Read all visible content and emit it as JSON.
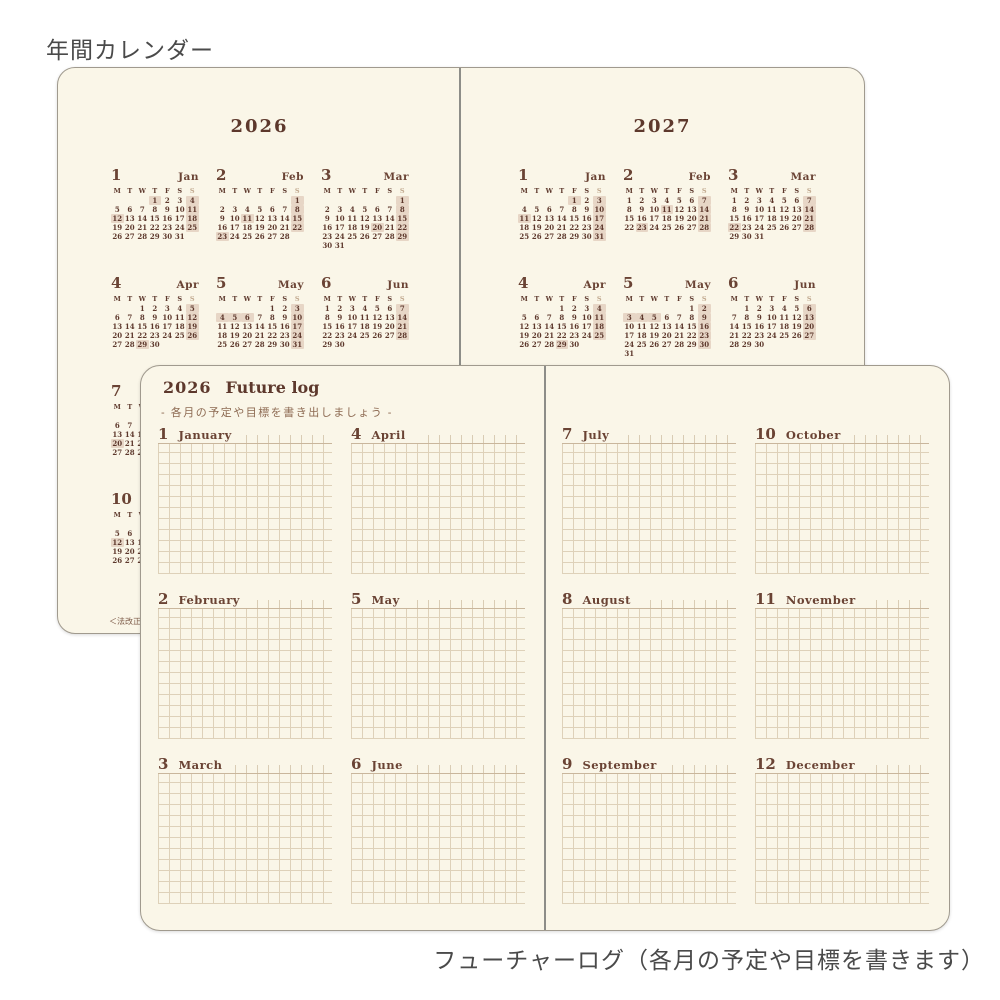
{
  "captions": {
    "top": "年間カレンダー",
    "bottom": "フューチャーログ（各月の予定や目標を書きます）"
  },
  "colors": {
    "paper": "#faf6e8",
    "ink": "#5d382c",
    "highlight": "#e7d6c6",
    "grid_line": "#ded1b9",
    "grid_line_dark": "#c9b69c",
    "sunday_header": "#c2aa90",
    "gutter": "#8d8d88",
    "caption": "#4a4a4a"
  },
  "yearly_calendar": {
    "weekday_header": [
      "M",
      "T",
      "W",
      "T",
      "F",
      "S",
      "S"
    ],
    "footnote": "＜法改正",
    "pages": [
      {
        "year": "2026",
        "months": [
          {
            "num": "1",
            "name": "Jan",
            "row": 0,
            "col": 0,
            "highlights": [
              "1",
              "4",
              "11",
              "12",
              "18",
              "25"
            ],
            "weeks": [
              [
                "",
                "",
                "",
                "1",
                "2",
                "3",
                "4"
              ],
              [
                "5",
                "6",
                "7",
                "8",
                "9",
                "10",
                "11"
              ],
              [
                "12",
                "13",
                "14",
                "15",
                "16",
                "17",
                "18"
              ],
              [
                "19",
                "20",
                "21",
                "22",
                "23",
                "24",
                "25"
              ],
              [
                "26",
                "27",
                "28",
                "29",
                "30",
                "31",
                ""
              ]
            ]
          },
          {
            "num": "2",
            "name": "Feb",
            "row": 0,
            "col": 1,
            "highlights": [
              "1",
              "8",
              "11",
              "15",
              "22",
              "23"
            ],
            "weeks": [
              [
                "",
                "",
                "",
                "",
                "",
                "",
                "1"
              ],
              [
                "2",
                "3",
                "4",
                "5",
                "6",
                "7",
                "8"
              ],
              [
                "9",
                "10",
                "11",
                "12",
                "13",
                "14",
                "15"
              ],
              [
                "16",
                "17",
                "18",
                "19",
                "20",
                "21",
                "22"
              ],
              [
                "23",
                "24",
                "25",
                "26",
                "27",
                "28",
                ""
              ]
            ]
          },
          {
            "num": "3",
            "name": "Mar",
            "row": 0,
            "col": 2,
            "highlights": [
              "1",
              "8",
              "15",
              "20",
              "22",
              "29"
            ],
            "weeks": [
              [
                "",
                "",
                "",
                "",
                "",
                "",
                "1"
              ],
              [
                "2",
                "3",
                "4",
                "5",
                "6",
                "7",
                "8"
              ],
              [
                "9",
                "10",
                "11",
                "12",
                "13",
                "14",
                "15"
              ],
              [
                "16",
                "17",
                "18",
                "19",
                "20",
                "21",
                "22"
              ],
              [
                "23",
                "24",
                "25",
                "26",
                "27",
                "28",
                "29"
              ],
              [
                "30",
                "31",
                "",
                "",
                "",
                "",
                ""
              ]
            ]
          },
          {
            "num": "4",
            "name": "Apr",
            "row": 1,
            "col": 0,
            "highlights": [
              "5",
              "12",
              "19",
              "26",
              "29"
            ],
            "weeks": [
              [
                "",
                "",
                "1",
                "2",
                "3",
                "4",
                "5"
              ],
              [
                "6",
                "7",
                "8",
                "9",
                "10",
                "11",
                "12"
              ],
              [
                "13",
                "14",
                "15",
                "16",
                "17",
                "18",
                "19"
              ],
              [
                "20",
                "21",
                "22",
                "23",
                "24",
                "25",
                "26"
              ],
              [
                "27",
                "28",
                "29",
                "30",
                "",
                "",
                ""
              ]
            ]
          },
          {
            "num": "5",
            "name": "May",
            "row": 1,
            "col": 1,
            "highlights": [
              "3",
              "4",
              "5",
              "6",
              "10",
              "17",
              "24",
              "31"
            ],
            "weeks": [
              [
                "",
                "",
                "",
                "",
                "1",
                "2",
                "3"
              ],
              [
                "4",
                "5",
                "6",
                "7",
                "8",
                "9",
                "10"
              ],
              [
                "11",
                "12",
                "13",
                "14",
                "15",
                "16",
                "17"
              ],
              [
                "18",
                "19",
                "20",
                "21",
                "22",
                "23",
                "24"
              ],
              [
                "25",
                "26",
                "27",
                "28",
                "29",
                "30",
                "31"
              ]
            ]
          },
          {
            "num": "6",
            "name": "Jun",
            "row": 1,
            "col": 2,
            "highlights": [
              "7",
              "14",
              "21",
              "28"
            ],
            "weeks": [
              [
                "1",
                "2",
                "3",
                "4",
                "5",
                "6",
                "7"
              ],
              [
                "8",
                "9",
                "10",
                "11",
                "12",
                "13",
                "14"
              ],
              [
                "15",
                "16",
                "17",
                "18",
                "19",
                "20",
                "21"
              ],
              [
                "22",
                "23",
                "24",
                "25",
                "26",
                "27",
                "28"
              ],
              [
                "29",
                "30",
                "",
                "",
                "",
                "",
                ""
              ]
            ]
          },
          {
            "num": "7",
            "name": "Jul",
            "row": 2,
            "col": 0,
            "highlights": [
              "5",
              "12",
              "19",
              "20",
              "26"
            ],
            "weeks": [
              [
                "",
                "",
                "1",
                "2",
                "3",
                "4",
                "5"
              ],
              [
                "6",
                "7",
                "8",
                "9",
                "10",
                "11",
                "12"
              ],
              [
                "13",
                "14",
                "15",
                "16",
                "17",
                "18",
                "19"
              ],
              [
                "20",
                "21",
                "22",
                "23",
                "24",
                "25",
                "26"
              ],
              [
                "27",
                "28",
                "29",
                "30",
                "31",
                "",
                ""
              ]
            ]
          },
          {
            "num": "10",
            "name": "Oct",
            "row": 3,
            "col": 0,
            "highlights": [
              "4",
              "11",
              "12",
              "18",
              "25"
            ],
            "weeks": [
              [
                "",
                "",
                "",
                "1",
                "2",
                "3",
                "4"
              ],
              [
                "5",
                "6",
                "7",
                "8",
                "9",
                "10",
                "11"
              ],
              [
                "12",
                "13",
                "14",
                "15",
                "16",
                "17",
                "18"
              ],
              [
                "19",
                "20",
                "21",
                "22",
                "23",
                "24",
                "25"
              ],
              [
                "26",
                "27",
                "28",
                "29",
                "30",
                "31",
                ""
              ]
            ]
          }
        ]
      },
      {
        "year": "2027",
        "months": [
          {
            "num": "1",
            "name": "Jan",
            "row": 0,
            "col": 0,
            "highlights": [
              "1",
              "3",
              "10",
              "11",
              "17",
              "24",
              "31"
            ],
            "weeks": [
              [
                "",
                "",
                "",
                "",
                "1",
                "2",
                "3"
              ],
              [
                "4",
                "5",
                "6",
                "7",
                "8",
                "9",
                "10"
              ],
              [
                "11",
                "12",
                "13",
                "14",
                "15",
                "16",
                "17"
              ],
              [
                "18",
                "19",
                "20",
                "21",
                "22",
                "23",
                "24"
              ],
              [
                "25",
                "26",
                "27",
                "28",
                "29",
                "30",
                "31"
              ]
            ]
          },
          {
            "num": "2",
            "name": "Feb",
            "row": 0,
            "col": 1,
            "highlights": [
              "7",
              "11",
              "14",
              "21",
              "23",
              "28"
            ],
            "weeks": [
              [
                "1",
                "2",
                "3",
                "4",
                "5",
                "6",
                "7"
              ],
              [
                "8",
                "9",
                "10",
                "11",
                "12",
                "13",
                "14"
              ],
              [
                "15",
                "16",
                "17",
                "18",
                "19",
                "20",
                "21"
              ],
              [
                "22",
                "23",
                "24",
                "25",
                "26",
                "27",
                "28"
              ]
            ]
          },
          {
            "num": "3",
            "name": "Mar",
            "row": 0,
            "col": 2,
            "highlights": [
              "7",
              "14",
              "21",
              "22",
              "28"
            ],
            "weeks": [
              [
                "1",
                "2",
                "3",
                "4",
                "5",
                "6",
                "7"
              ],
              [
                "8",
                "9",
                "10",
                "11",
                "12",
                "13",
                "14"
              ],
              [
                "15",
                "16",
                "17",
                "18",
                "19",
                "20",
                "21"
              ],
              [
                "22",
                "23",
                "24",
                "25",
                "26",
                "27",
                "28"
              ],
              [
                "29",
                "30",
                "31",
                "",
                "",
                "",
                ""
              ]
            ]
          },
          {
            "num": "4",
            "name": "Apr",
            "row": 1,
            "col": 0,
            "highlights": [
              "4",
              "11",
              "18",
              "25",
              "29"
            ],
            "weeks": [
              [
                "",
                "",
                "",
                "1",
                "2",
                "3",
                "4"
              ],
              [
                "5",
                "6",
                "7",
                "8",
                "9",
                "10",
                "11"
              ],
              [
                "12",
                "13",
                "14",
                "15",
                "16",
                "17",
                "18"
              ],
              [
                "19",
                "20",
                "21",
                "22",
                "23",
                "24",
                "25"
              ],
              [
                "26",
                "27",
                "28",
                "29",
                "30",
                "",
                ""
              ]
            ]
          },
          {
            "num": "5",
            "name": "May",
            "row": 1,
            "col": 1,
            "highlights": [
              "2",
              "3",
              "4",
              "5",
              "9",
              "16",
              "23",
              "30"
            ],
            "weeks": [
              [
                "",
                "",
                "",
                "",
                "",
                "1",
                "2"
              ],
              [
                "3",
                "4",
                "5",
                "6",
                "7",
                "8",
                "9"
              ],
              [
                "10",
                "11",
                "12",
                "13",
                "14",
                "15",
                "16"
              ],
              [
                "17",
                "18",
                "19",
                "20",
                "21",
                "22",
                "23"
              ],
              [
                "24",
                "25",
                "26",
                "27",
                "28",
                "29",
                "30"
              ],
              [
                "31",
                "",
                "",
                "",
                "",
                "",
                ""
              ]
            ]
          },
          {
            "num": "6",
            "name": "Jun",
            "row": 1,
            "col": 2,
            "highlights": [
              "6",
              "13",
              "20",
              "27"
            ],
            "weeks": [
              [
                "",
                "1",
                "2",
                "3",
                "4",
                "5",
                "6"
              ],
              [
                "7",
                "8",
                "9",
                "10",
                "11",
                "12",
                "13"
              ],
              [
                "14",
                "15",
                "16",
                "17",
                "18",
                "19",
                "20"
              ],
              [
                "21",
                "22",
                "23",
                "24",
                "25",
                "26",
                "27"
              ],
              [
                "28",
                "29",
                "30",
                "",
                "",
                "",
                ""
              ]
            ]
          }
        ]
      }
    ]
  },
  "future_log": {
    "year": "2026",
    "title": "Future log",
    "subtitle": "- 各月の予定や目標を書き出しましょう -",
    "pages": [
      {
        "sections": [
          {
            "num": "1",
            "name": "January"
          },
          {
            "num": "4",
            "name": "April"
          },
          {
            "num": "2",
            "name": "February"
          },
          {
            "num": "5",
            "name": "May"
          },
          {
            "num": "3",
            "name": "March"
          },
          {
            "num": "6",
            "name": "June"
          }
        ]
      },
      {
        "sections": [
          {
            "num": "7",
            "name": "July"
          },
          {
            "num": "10",
            "name": "October"
          },
          {
            "num": "8",
            "name": "August"
          },
          {
            "num": "11",
            "name": "November"
          },
          {
            "num": "9",
            "name": "September"
          },
          {
            "num": "12",
            "name": "December"
          }
        ]
      }
    ]
  }
}
